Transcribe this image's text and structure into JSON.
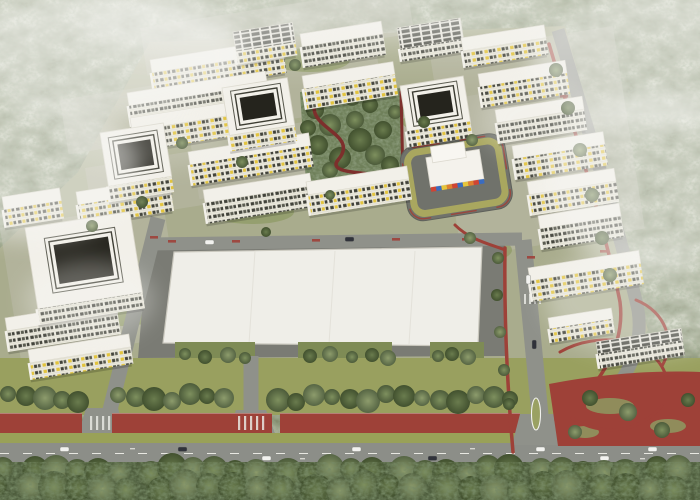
{
  "meta": {
    "description": "Aerial 3D architectural rendering of a white residential masterplan with courtyard blocks, a colorful kindergarten, a large white commercial hall, red bike paths, tree-lined boulevard and surrounding foggy forest",
    "width": 700,
    "height": 500
  },
  "palette": {
    "forest_base": "#7b8566",
    "forest_light": "#a3ac8c",
    "forest_dark": "#5a674b",
    "forest_bottom": "#4e5d3d",
    "fog": "#f6f6f3",
    "site_ground": "#a9ac8d",
    "paving": "#bdbcae",
    "lawn_patch": "#8d9a62",
    "roof_white": "#f2f0e9",
    "roof_stroke": "#d9d6ca",
    "facade": "#eae8dc",
    "window_dark": "#41423a",
    "window_mid": "#5a5b50",
    "accent_yellow": "#e2c33c",
    "courtyard_dark": "#25241d",
    "road": "#8f918a",
    "road_main": "#8c8e88",
    "asphalt": "#7a7b74",
    "lawn_band": "#99a05f",
    "olive_band": "#99a158",
    "path_red": "#9e4138",
    "path_red_dark": "#7d2f2c",
    "park_green": "#6f805a",
    "tree_pad": "#7e8b55",
    "kg_red": "#cf4434",
    "kg_blue": "#3a6cc0",
    "kg_yellow": "#e5c53b",
    "kg_orange": "#df8030",
    "car_light": "#f2f2ef",
    "car_dark": "#30323a",
    "marking_white": "#e8e8e2"
  },
  "site": {
    "outline": "150,42 565,26 648,330 602,395 0,395 0,248 78,172",
    "paving_strips": [
      [
        60,
        100,
        320,
        55
      ],
      [
        85,
        168,
        340,
        55
      ],
      [
        140,
        28,
        270,
        48
      ],
      [
        430,
        55,
        185,
        205
      ],
      [
        0,
        228,
        165,
        135
      ],
      [
        190,
        140,
        330,
        60
      ]
    ],
    "lawns": [
      [
        470,
        250,
        42,
        14
      ],
      [
        432,
        122,
        30,
        10
      ],
      [
        252,
        212,
        42,
        12
      ],
      [
        122,
        312,
        40,
        14
      ],
      [
        310,
        60,
        40,
        12
      ]
    ]
  },
  "hall": {
    "plot": "148,238 505,236 505,356 138,358",
    "roof": "174,252 482,247 478,346 163,343",
    "seams_x": [
      255,
      335,
      415
    ],
    "tree_pads": [
      [
        175,
        342,
        80,
        30
      ],
      [
        298,
        342,
        94,
        30
      ],
      [
        430,
        342,
        54,
        30
      ]
    ]
  },
  "roads": {
    "segments": [
      {
        "d": "M158,218 L100,450",
        "w": 15
      },
      {
        "d": "M148,244 L522,239",
        "w": 13
      },
      {
        "d": "M523,240 L544,456",
        "w": 17
      },
      {
        "d": "M558,30 C585,120 625,250 638,310 C646,360 612,408 560,428 L552,452",
        "w": 13
      },
      {
        "d": "M251,356 L251,445",
        "w": 15
      }
    ],
    "flares": [
      "236,410 266,410 276,436 226,436",
      "86,408 118,408 126,436 78,436",
      "520,414 556,414 566,445 512,445"
    ],
    "bottom_band": [
      0,
      443,
      700,
      21
    ],
    "lawn_band": [
      0,
      358,
      700,
      57
    ],
    "olive_band": [
      0,
      433,
      700,
      10
    ],
    "center_line": {
      "d": "M0,453.5 L700,453.5",
      "dash": "9 14"
    },
    "lane_ticks": [
      [
        130,
        448
      ],
      [
        300,
        458
      ],
      [
        470,
        448
      ],
      [
        640,
        458
      ]
    ],
    "median": {
      "cx": 536,
      "cy": 414,
      "rx": 4.5,
      "ry": 16
    },
    "crosswalks": [
      {
        "x": 238,
        "y": 416,
        "n": 5,
        "dx": 6,
        "w": 2.2,
        "h": 14
      },
      {
        "x": 90,
        "y": 416,
        "n": 4,
        "dx": 6,
        "w": 2.2,
        "h": 14
      },
      {
        "x": 524,
        "y": 294,
        "n": 4,
        "dx": 5,
        "w": 2,
        "h": 10
      }
    ]
  },
  "red": {
    "strips": [
      [
        0,
        413,
        82,
        20
      ],
      [
        112,
        413,
        160,
        20
      ],
      [
        280,
        413,
        240,
        20
      ]
    ],
    "plaza": "M549,384 C600,374 655,370 700,372 L700,446 L558,446 Z",
    "plaza_lawns": [
      [
        610,
        406,
        24,
        8
      ],
      [
        668,
        426,
        18,
        7
      ],
      [
        585,
        432,
        14,
        6
      ]
    ],
    "paths": [
      {
        "d": "M549,44 C574,128 610,250 620,302 C626,348 596,392 556,420",
        "w": 3.5
      },
      {
        "d": "M505,248 C504,320 508,395 513,452",
        "w": 3.5
      },
      {
        "d": "M455,225 C470,240 490,244 505,250",
        "w": 3
      },
      {
        "d": "M560,352 C598,330 654,338 666,376",
        "w": 3
      },
      {
        "d": "M572,418 C602,438 640,432 662,406",
        "w": 3
      },
      {
        "d": "M636,300 C666,312 676,342 662,366",
        "w": 3
      }
    ],
    "marks": [
      [
        168,
        240,
        "h"
      ],
      [
        232,
        240,
        "h"
      ],
      [
        312,
        239,
        "h"
      ],
      [
        392,
        238,
        "h"
      ],
      [
        462,
        238,
        "h"
      ],
      [
        150,
        236,
        "h"
      ],
      [
        134,
        292,
        "v"
      ],
      [
        118,
        354,
        "v"
      ],
      [
        527,
        256,
        "h"
      ],
      [
        560,
        95,
        "h"
      ],
      [
        576,
        150,
        "h"
      ],
      [
        590,
        200,
        "h"
      ],
      [
        600,
        250,
        "h"
      ]
    ]
  },
  "park": {
    "outline": "300,92 404,88 402,180 306,182",
    "paths": [
      {
        "d": "M318,96 C298,128 362,132 338,160 C326,175 372,172 396,177",
        "w": 3.5
      },
      {
        "d": "M401,92 L403,178",
        "w": 3
      }
    ],
    "trees": [
      [
        315,
        110,
        9,
        1
      ],
      [
        330,
        125,
        11,
        0
      ],
      [
        318,
        145,
        10,
        1
      ],
      [
        340,
        158,
        11,
        1
      ],
      [
        355,
        120,
        9,
        0
      ],
      [
        360,
        140,
        12,
        1
      ],
      [
        375,
        155,
        10,
        0
      ],
      [
        383,
        130,
        9,
        1
      ],
      [
        390,
        165,
        9,
        1
      ],
      [
        352,
        98,
        8,
        0
      ],
      [
        370,
        105,
        8,
        1
      ],
      [
        395,
        112,
        7,
        0
      ],
      [
        330,
        170,
        8,
        0
      ],
      [
        308,
        128,
        8,
        1
      ]
    ]
  },
  "kindergarten": {
    "plot": {
      "x": 398,
      "y": 148,
      "w": 106,
      "h": 76,
      "rx": 16
    },
    "ring_inset": 7,
    "building_main": [
      424,
      162,
      54,
      30
    ],
    "building_upper": [
      430,
      152,
      34,
      16
    ],
    "stripe_colors": [
      "#cf4434",
      "#3a6cc0",
      "#e5c53b",
      "#df8030",
      "#cf4434",
      "#3a6cc0",
      "#e5c53b",
      "#df8030",
      "#cf4434",
      "#3a6cc0"
    ]
  },
  "buildings": {
    "rot": -9,
    "slabs": [
      {
        "x": 150,
        "y": 60,
        "w": 133
      },
      {
        "x": 127,
        "y": 93,
        "w": 140
      },
      {
        "x": 130,
        "y": 118,
        "w": 132
      },
      {
        "x": 188,
        "y": 152,
        "w": 122
      },
      {
        "x": 203,
        "y": 190,
        "w": 108
      },
      {
        "x": 76,
        "y": 192,
        "w": 94
      },
      {
        "x": 2,
        "y": 197,
        "w": 58,
        "fh": 18
      },
      {
        "x": 5,
        "y": 318,
        "w": 112
      },
      {
        "x": 28,
        "y": 350,
        "w": 102,
        "fh": 17
      },
      {
        "x": 233,
        "y": 32,
        "w": 60,
        "d": 20,
        "fh": 13,
        "roof": "panels"
      },
      {
        "x": 300,
        "y": 34,
        "w": 82
      },
      {
        "x": 302,
        "y": 76,
        "w": 92
      },
      {
        "x": 306,
        "y": 182,
        "w": 102
      },
      {
        "x": 397,
        "y": 28,
        "w": 64,
        "d": 21,
        "fh": 13,
        "roof": "panels"
      },
      {
        "x": 461,
        "y": 38,
        "w": 84,
        "fh": 17
      },
      {
        "x": 478,
        "y": 74,
        "w": 88
      },
      {
        "x": 495,
        "y": 110,
        "w": 88
      },
      {
        "x": 512,
        "y": 146,
        "w": 92
      },
      {
        "x": 527,
        "y": 182,
        "w": 88
      },
      {
        "x": 538,
        "y": 216,
        "w": 82
      },
      {
        "x": 528,
        "y": 268,
        "w": 112
      },
      {
        "x": 548,
        "y": 318,
        "w": 64,
        "d": 11,
        "fh": 14
      },
      {
        "x": 596,
        "y": 342,
        "w": 86,
        "d": 12,
        "fh": 15,
        "roof": "panels"
      }
    ],
    "courtyards": [
      {
        "x": 100,
        "y": 133,
        "w": 64,
        "h": 54
      },
      {
        "x": 25,
        "y": 228,
        "w": 106,
        "h": 82
      },
      {
        "x": 222,
        "y": 88,
        "w": 66,
        "h": 48
      },
      {
        "x": 400,
        "y": 86,
        "w": 64,
        "h": 46
      }
    ]
  },
  "trees": {
    "street_row": {
      "y": 398,
      "xs": [
        8,
        26,
        45,
        62,
        78,
        118,
        136,
        154,
        172,
        190,
        207,
        224,
        278,
        296,
        314,
        332,
        350,
        368,
        386,
        404,
        422,
        440,
        458,
        476,
        494,
        510
      ]
    },
    "bottom_rows": [
      {
        "y": 471,
        "x0": 8,
        "x1": 695,
        "step": 23,
        "r": 13
      },
      {
        "y": 488,
        "x0": 0,
        "x1": 700,
        "step": 26,
        "r": 14
      }
    ],
    "pad_trees": {
      "y": 356,
      "xs": [
        185,
        205,
        228,
        245,
        310,
        330,
        352,
        372,
        388,
        438,
        452,
        468
      ]
    },
    "roadside": [
      [
        556,
        70,
        7
      ],
      [
        568,
        108,
        7
      ],
      [
        580,
        150,
        7
      ],
      [
        592,
        195,
        7
      ],
      [
        602,
        238,
        7
      ],
      [
        610,
        275,
        7
      ],
      [
        498,
        258,
        6
      ],
      [
        497,
        295,
        6
      ],
      [
        500,
        332,
        6
      ],
      [
        504,
        370,
        6
      ],
      [
        509,
        404,
        6
      ]
    ],
    "plaza": [
      [
        590,
        398,
        8
      ],
      [
        628,
        412,
        9
      ],
      [
        662,
        430,
        8
      ],
      [
        688,
        400,
        7
      ],
      [
        575,
        432,
        7
      ]
    ],
    "scatter": [
      [
        295,
        65,
        6
      ],
      [
        424,
        122,
        6
      ],
      [
        472,
        140,
        6
      ],
      [
        182,
        143,
        6
      ],
      [
        142,
        202,
        6
      ],
      [
        92,
        226,
        6
      ],
      [
        242,
        162,
        6
      ],
      [
        266,
        232,
        5
      ],
      [
        470,
        238,
        6
      ],
      [
        330,
        195,
        5
      ]
    ]
  },
  "cars": {
    "bottom": [
      [
        60,
        447,
        "l"
      ],
      [
        178,
        447,
        "d"
      ],
      [
        262,
        456,
        "l"
      ],
      [
        352,
        447,
        "l"
      ],
      [
        428,
        456,
        "d"
      ],
      [
        536,
        447,
        "l"
      ],
      [
        600,
        456,
        "l"
      ],
      [
        648,
        447,
        "l"
      ]
    ],
    "vertical": [
      [
        526,
        275,
        "l"
      ],
      [
        532,
        340,
        "d"
      ]
    ],
    "middle": [
      [
        205,
        240,
        "l"
      ],
      [
        345,
        237,
        "d"
      ]
    ]
  },
  "fog": [
    {
      "cx": 95,
      "cy": 55,
      "rx": 150,
      "ry": 65,
      "o": 0.6
    },
    {
      "cx": 30,
      "cy": 170,
      "rx": 110,
      "ry": 70,
      "o": 0.5
    },
    {
      "cx": 200,
      "cy": 25,
      "rx": 120,
      "ry": 35,
      "o": 0.35
    },
    {
      "cx": 420,
      "cy": 12,
      "rx": 140,
      "ry": 30,
      "o": 0.3
    },
    {
      "cx": 660,
      "cy": 60,
      "rx": 130,
      "ry": 70,
      "o": 0.5
    },
    {
      "cx": 655,
      "cy": 180,
      "rx": 110,
      "ry": 90,
      "o": 0.5
    },
    {
      "cx": 645,
      "cy": 300,
      "rx": 100,
      "ry": 55,
      "o": 0.35
    },
    {
      "cx": 145,
      "cy": 140,
      "rx": 90,
      "ry": 28,
      "o": 0.2
    },
    {
      "cx": 90,
      "cy": 300,
      "rx": 65,
      "ry": 40,
      "o": 0.3
    },
    {
      "cx": 540,
      "cy": 120,
      "rx": 60,
      "ry": 40,
      "o": 0.25
    }
  ]
}
